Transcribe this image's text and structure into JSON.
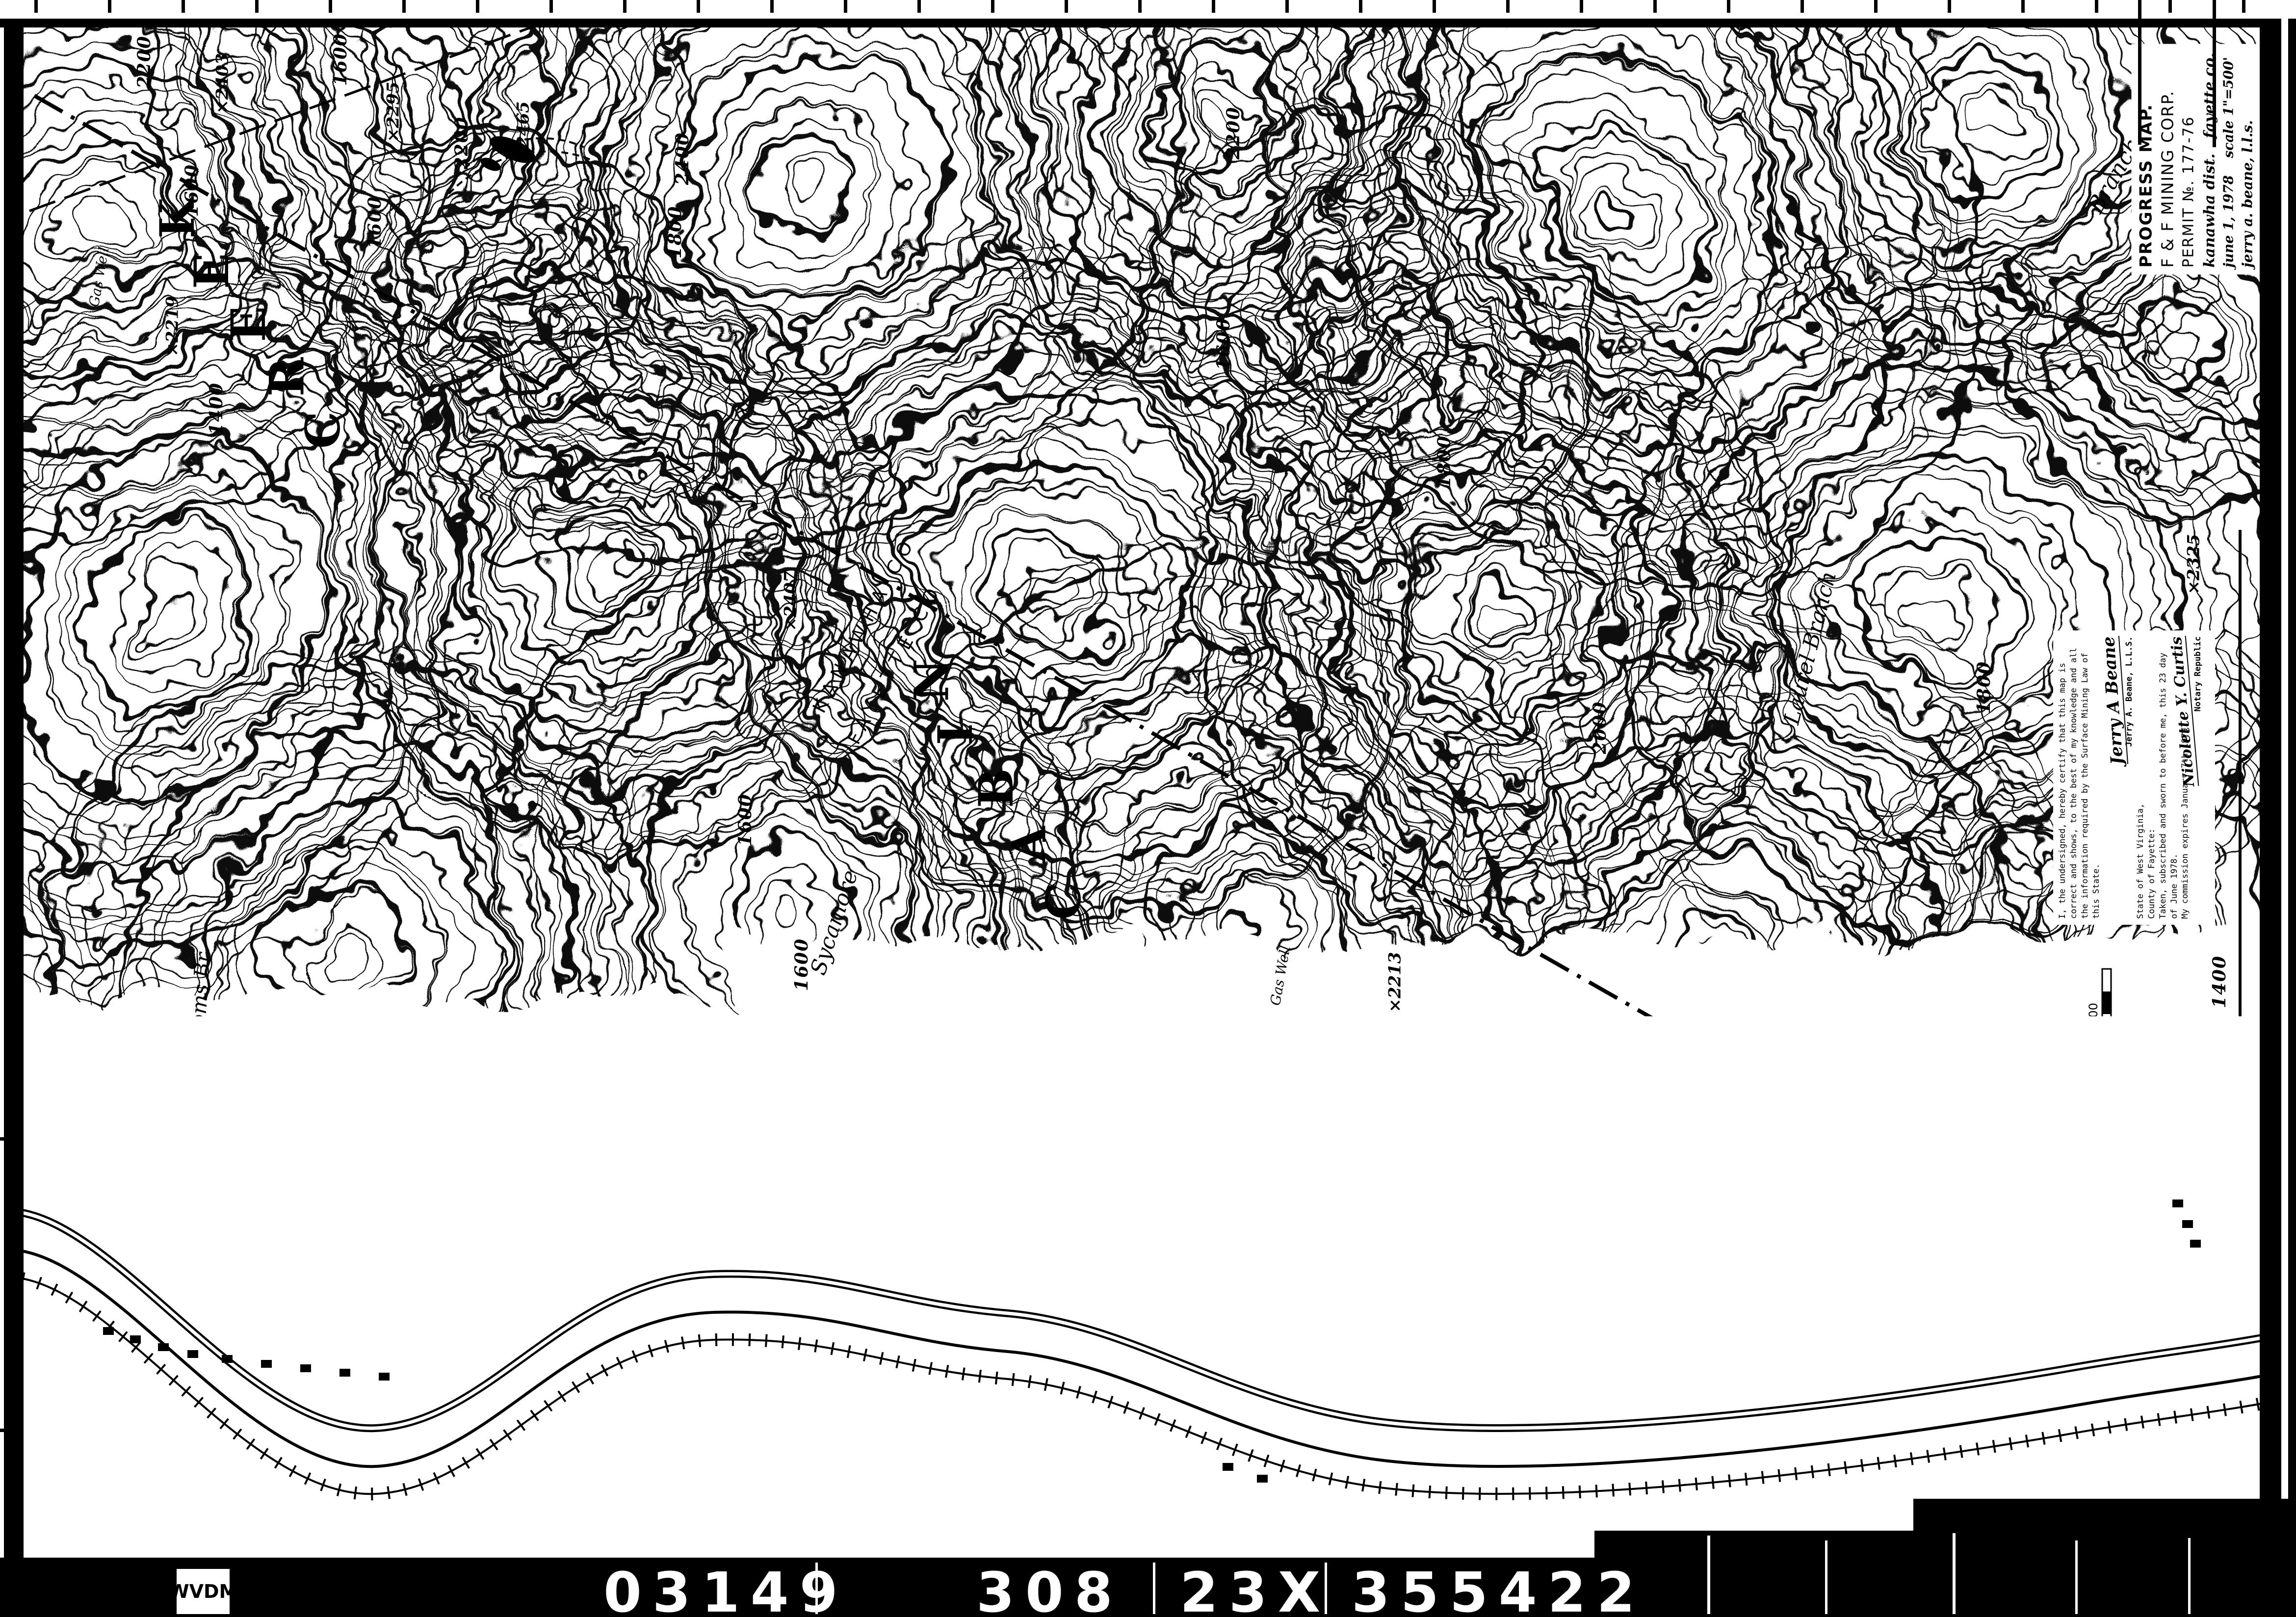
{
  "film_footer": {
    "agency": "WVDM",
    "n1": "03149",
    "n2": "308",
    "n3": "23X",
    "n4": "355422"
  },
  "title_block": {
    "line1": "PROGRESS MAP.",
    "line2": "F & F MINING CORP.",
    "line3": "PERMIT №. 177-76",
    "line4a": "kanawha dist.",
    "line4b": "fayette co.",
    "line5a": "june 1, 1978",
    "line5b": "scale 1\"=500'",
    "line6": "jerry a. beane, l.l.s."
  },
  "certification": {
    "body": "I, the undersigned, hereby certify that this map is correct and shows, to the best of my knowledge and all the information required by the Surface Mining Law of this State.",
    "sig1_script": "Jerry A Beane",
    "sig1_name": "Jerry A. Beane, L.L.S.",
    "notary1": "State of West Virginia,",
    "notary2": "County of Fayette:",
    "notary3": "Taken, subscribed and sworn to before me, this 23 day",
    "notary4": "of June 1978.",
    "notary5": "My commission expires January 7th 1979.",
    "sig2_script": "Nicolette Y. Curtis",
    "sig2_name": "Notary Republic"
  },
  "legend": {
    "title": "LEGEND",
    "seam_note": "№ 5 - Black Seam",
    "rows": [
      {
        "label": "CROP LINE",
        "note": "5000 Lin.ft. Proposed",
        "value": ""
      },
      {
        "label": "COAL",
        "note": "",
        "value": "3000 . lin. ft."
      },
      {
        "label": "COAL REMOVED TO 5-3-78",
        "note": "",
        "value": "2080  lin.ft."
      },
      {
        "label": "PROPOSED DISTURBED AREA",
        "note": "",
        "value": "36.00 ac."
      },
      {
        "label": "DRAINAGE",
        "note": "Paint Creek",
        "value": ""
      },
      {
        "label": "DISTURBED AREA TO 5-3-78",
        "note": "",
        "value": "7.43 ac."
      },
      {
        "label": "ACRES REGRADED TO 5-3-78",
        "note": "",
        "value": "4.71 ac."
      },
      {
        "label": "HAUL ROAD",
        "note": "800 l.f. incl'd above",
        "value": "1.00 ac."
      }
    ],
    "table": {
      "headers": [
        "TRACT",
        "OWNER",
        "DISTURBED AREA",
        "REGRADED AREA"
      ],
      "row": [
        "A",
        "EACC",
        "7.43",
        "4.71"
      ]
    }
  },
  "location_map": {
    "title": "LOCATION MAP",
    "series_note1": "7.5 Minute Series",
    "series_note2": "Contour Interval 40'",
    "lat": "38°03'15\"",
    "lat_suffix": "Lat.",
    "lon": "81°30'45\"",
    "agency": "U.S.G.S.",
    "quad_note": "Quadrangle",
    "state": "W.VA.",
    "labels": {
      "county_left": "KANAWHA CO.",
      "county_right": "Fayette Co.",
      "town1": "Montgomery",
      "town2": "East Bank",
      "town3": "Mahan",
      "town4": "Burnwell",
      "river": "Kanawha River"
    }
  },
  "scale_bar": {
    "ticks": [
      "0",
      "500",
      "1000",
      "1500"
    ],
    "label": "Scale, feet"
  },
  "county_line": {
    "upper": "KANAWHA CO",
    "lower": "FAYETTE CO"
  },
  "towns": [
    {
      "t": "Whittaker"
    },
    {
      "t": "Burnwell"
    },
    {
      "t": "Carbondale"
    }
  ],
  "streams": [
    {
      "t": "Paint Creek"
    },
    {
      "t": "Toms Br"
    },
    {
      "t": "Sycamore"
    },
    {
      "t": "Laurel Branch"
    },
    {
      "t": "Branch"
    }
  ],
  "roads": {
    "toll": "TOLL ROAD",
    "rail": "C & O",
    "shield": "11"
  },
  "wells": {
    "label": "Gas Well"
  },
  "benchmarks": [
    {
      "t": "802"
    },
    {
      "t": "868"
    }
  ],
  "spot_marker": "×",
  "spot_elevations": [
    {
      "t": "2403"
    },
    {
      "t": "2295"
    },
    {
      "t": "2465"
    },
    {
      "t": "2219"
    },
    {
      "t": "2407"
    },
    {
      "t": "2213"
    },
    {
      "t": "2325"
    }
  ],
  "contour_labels": [
    {
      "t": "2200"
    },
    {
      "t": "1600"
    },
    {
      "t": "2200"
    },
    {
      "t": "2400"
    },
    {
      "t": "1800"
    },
    {
      "t": "1600"
    },
    {
      "t": "1600"
    },
    {
      "t": "1400"
    },
    {
      "t": "1600"
    },
    {
      "t": "1600"
    },
    {
      "t": "2000"
    },
    {
      "t": "1800"
    },
    {
      "t": "1400"
    },
    {
      "t": "1800"
    },
    {
      "t": "1200"
    },
    {
      "t": "1000"
    },
    {
      "t": "1000"
    },
    {
      "t": "1600"
    },
    {
      "t": "1800"
    },
    {
      "t": "2200"
    }
  ],
  "spread_letters": {
    "w1": [
      "C",
      "A",
      "B",
      "I",
      "N"
    ],
    "w2": [
      "C",
      "R",
      "E",
      "E",
      "K"
    ]
  }
}
